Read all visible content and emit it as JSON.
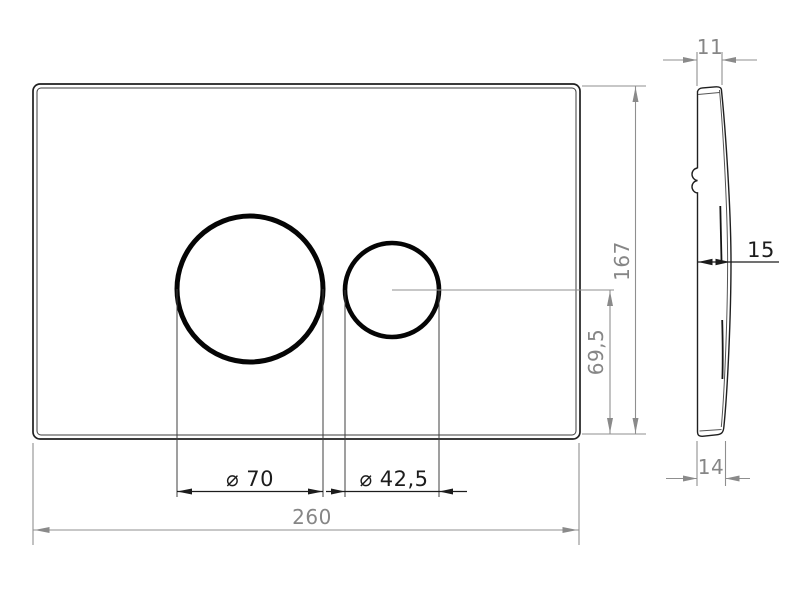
{
  "page": {
    "background": "#ffffff"
  },
  "drawing": {
    "type": "technical-drawing",
    "front_view": {
      "dimensions": {
        "overall_width": {
          "label": "260",
          "value_mm": 260
        },
        "overall_height": {
          "label": "167",
          "value_mm": 167
        },
        "button_axis_height": {
          "label": "69,5",
          "value_mm": 69.5
        },
        "large_button_diameter": {
          "label": "⌀ 70",
          "value_mm": 70
        },
        "small_button_diameter": {
          "label": "⌀ 42,5",
          "value_mm": 42.5
        }
      }
    },
    "side_view": {
      "dimensions": {
        "top_depth": {
          "label": "11",
          "value_mm": 11
        },
        "mid_depth": {
          "label": "15",
          "value_mm": 15
        },
        "bottom_depth": {
          "label": "14",
          "value_mm": 14
        }
      }
    },
    "colors": {
      "outline": "#1f1f1f",
      "feature_dimension": "#1c1c1c",
      "overall_dimension": "#8a8a8a",
      "background": "#ffffff"
    }
  }
}
